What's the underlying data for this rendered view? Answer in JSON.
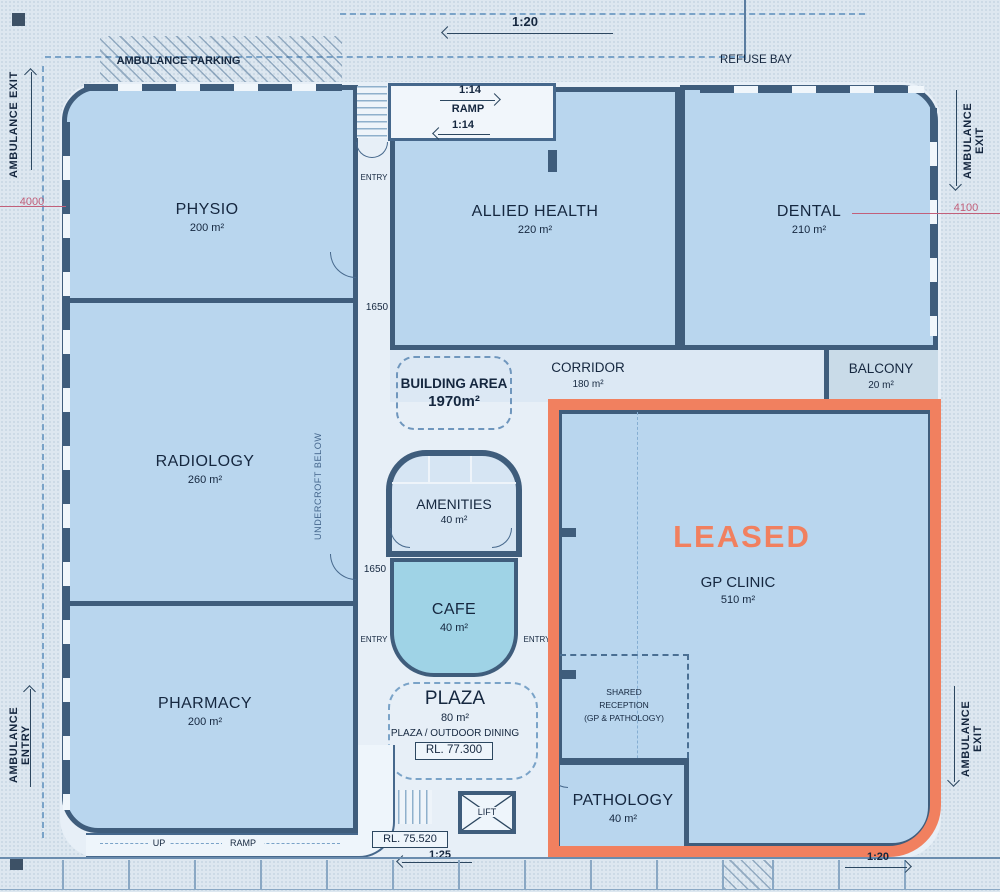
{
  "site": {
    "ambulance_parking": "AMBULANCE PARKING",
    "refuse_bay": "REFUSE BAY",
    "ambulance_exit": "AMBULANCE EXIT",
    "ambulance_entry": "AMBULANCE ENTRY",
    "dim_left": "4000",
    "dim_right": "4100",
    "slope_top": "1:20",
    "slope_bottom_left": "1:25",
    "slope_bottom_right": "1:20",
    "up_label": "UP",
    "ramp_label": "RAMP",
    "rl_lower": "RL. 75.520"
  },
  "ramp": {
    "slope_a": "1:14",
    "label": "RAMP",
    "slope_b": "1:14"
  },
  "rooms": {
    "physio": {
      "name": "PHYSIO",
      "area": "200 m²"
    },
    "radiology": {
      "name": "RADIOLOGY",
      "area": "260 m²"
    },
    "pharmacy": {
      "name": "PHARMACY",
      "area": "200 m²"
    },
    "allied_health": {
      "name": "ALLIED HEALTH",
      "area": "220 m²"
    },
    "dental": {
      "name": "DENTAL",
      "area": "210 m²"
    },
    "corridor": {
      "name": "CORRIDOR",
      "area": "180 m²"
    },
    "balcony": {
      "name": "BALCONY",
      "area": "20 m²"
    },
    "amenities": {
      "name": "AMENITIES",
      "area": "40 m²"
    },
    "cafe": {
      "name": "CAFE",
      "area": "40 m²"
    },
    "gp_clinic": {
      "name": "GP CLINIC",
      "area": "510 m²"
    },
    "pathology": {
      "name": "PATHOLOGY",
      "area": "40 m²"
    }
  },
  "plaza": {
    "name": "PLAZA",
    "area": "80 m²",
    "subtitle": "PLAZA / OUTDOOR DINING",
    "rl": "RL. 77.300"
  },
  "annotations": {
    "building_area_title": "BUILDING AREA",
    "building_area_value": "1970m²",
    "leased": "LEASED",
    "shared_l1": "SHARED",
    "shared_l2": "RECEPTION",
    "shared_l3": "(GP & PATHOLOGY)",
    "undercroft": "UNDERCROFT BELOW",
    "entry": "ENTRY",
    "dim_1650": "1650",
    "lift": "LIFT"
  },
  "colors": {
    "leased_accent": "#f1805f",
    "wall": "#3f5d7c",
    "room_fill": "#b9d6ee",
    "cafe_fill": "#9fd3e6",
    "dimension_red": "#c2607a"
  }
}
